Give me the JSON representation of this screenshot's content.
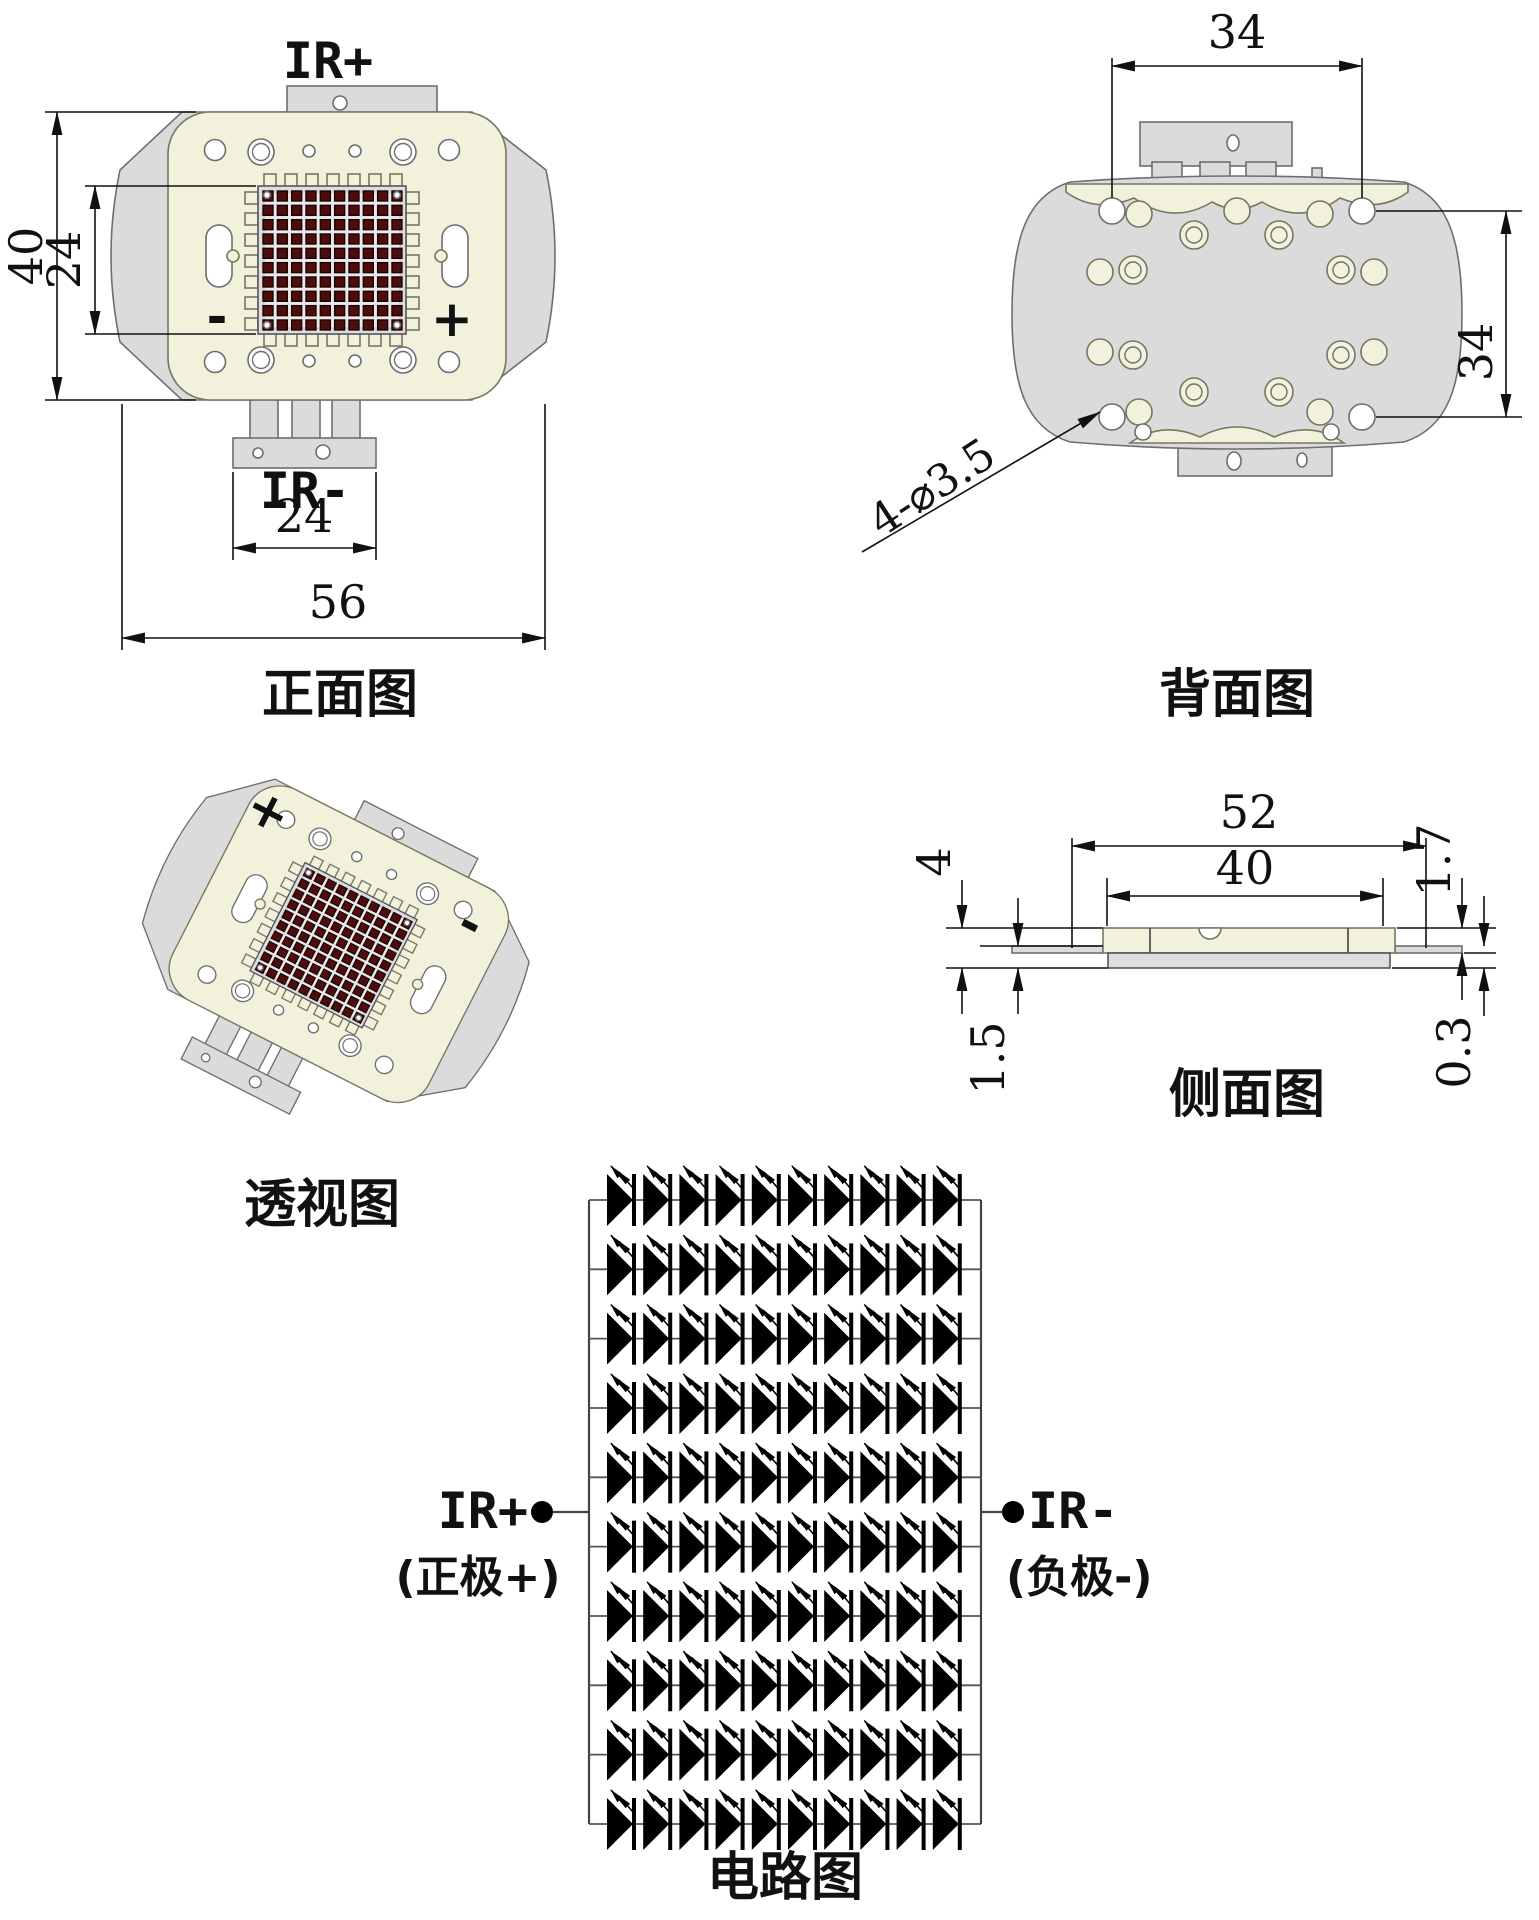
{
  "front_view": {
    "title": "正面图",
    "anode_label": "IR+",
    "cathode_label": "IR-",
    "minus_mark": "-",
    "plus_mark": "+",
    "dim_height": "40",
    "dim_led_height": "24",
    "dim_tab_width": "24",
    "dim_width": "56"
  },
  "back_view": {
    "title": "背面图",
    "dim_top": "34",
    "dim_side": "34",
    "dim_holes": "4-⌀3.5"
  },
  "perspective_view": {
    "title": "透视图",
    "plus_mark": "+",
    "minus_mark": "-"
  },
  "side_view": {
    "title": "侧面图",
    "dim_total_width": "52",
    "dim_body_width": "40",
    "dim_left_outer": "4",
    "dim_left_inner": "1.5",
    "dim_right_outer": "1.7",
    "dim_right_inner": "0.3"
  },
  "circuit": {
    "title": "电路图",
    "anode_label": "IR+",
    "anode_sub": "(正极+)",
    "cathode_label": "IR-",
    "cathode_sub": "(负极-)",
    "rows": 10,
    "cols": 10
  },
  "led_grid": {
    "rows": 10,
    "cols": 10
  },
  "colors": {
    "cream": "#f2f1dc",
    "gray": "#dbdbdb",
    "substrate": "#dedede",
    "led": "#4e0d0d",
    "led_stroke": "#1d0303",
    "line": "#111111"
  }
}
